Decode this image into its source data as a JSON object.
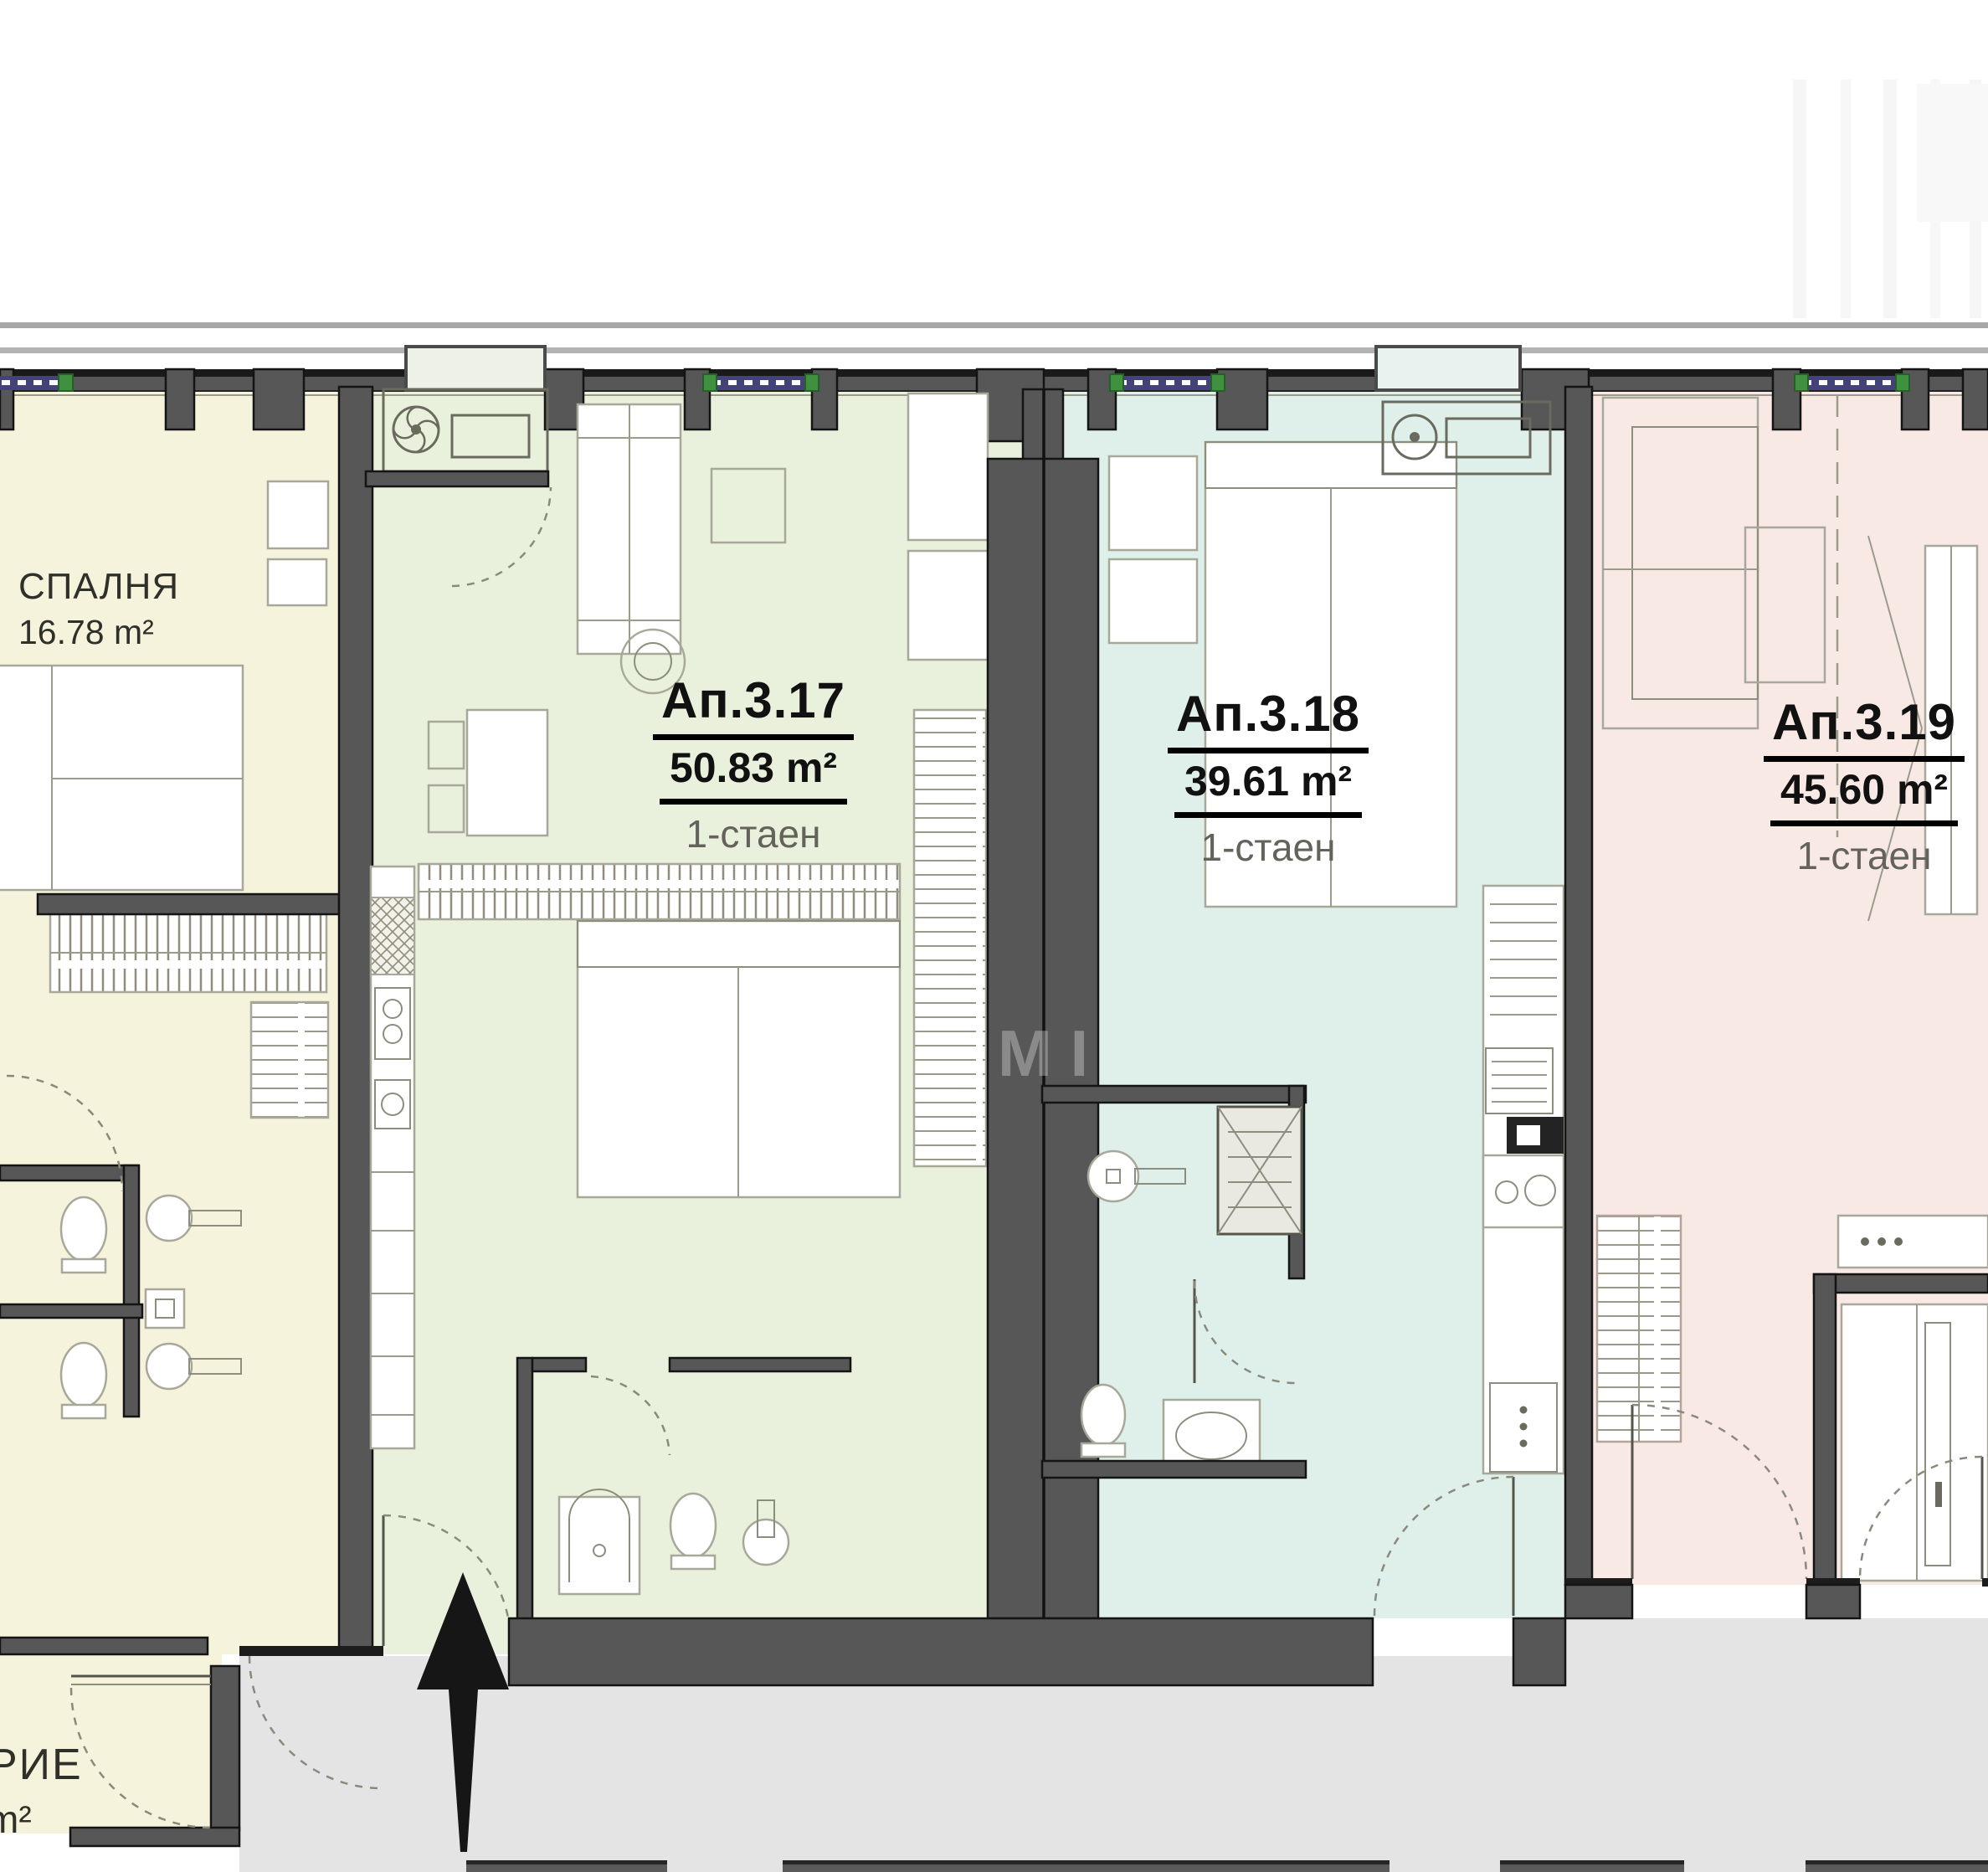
{
  "plan": {
    "apartments": [
      {
        "id": "ap-3-17",
        "name": "Ап.3.17",
        "area": "50.83 m²",
        "type": "1-стаен",
        "fill": "#e9f1dc"
      },
      {
        "id": "ap-3-18",
        "name": "Ап.3.18",
        "area": "39.61 m²",
        "type": "1-стаен",
        "fill": "#def0e9"
      },
      {
        "id": "ap-3-19",
        "name": "Ап.3.19",
        "area": "45.60 m²",
        "type": "1-стаен",
        "fill": "#f9e9e4"
      }
    ],
    "rooms": [
      {
        "id": "bedroom-left",
        "name": "СПАЛНЯ",
        "area": "16.78 m²",
        "fill": "#f6f3dc"
      }
    ],
    "partial_label": {
      "name": "РИЕ",
      "area_unit": "m²"
    },
    "watermark": "М І",
    "colors": {
      "cream": "#f6f3dc",
      "green": "#e9f1dc",
      "teal": "#def0e9",
      "pink": "#f9e9e4",
      "corridor": "#e4e4e4",
      "wall": "#575757",
      "wall_edge": "#141414",
      "window_blue": "#43437a",
      "window_green": "#3f9140"
    }
  }
}
